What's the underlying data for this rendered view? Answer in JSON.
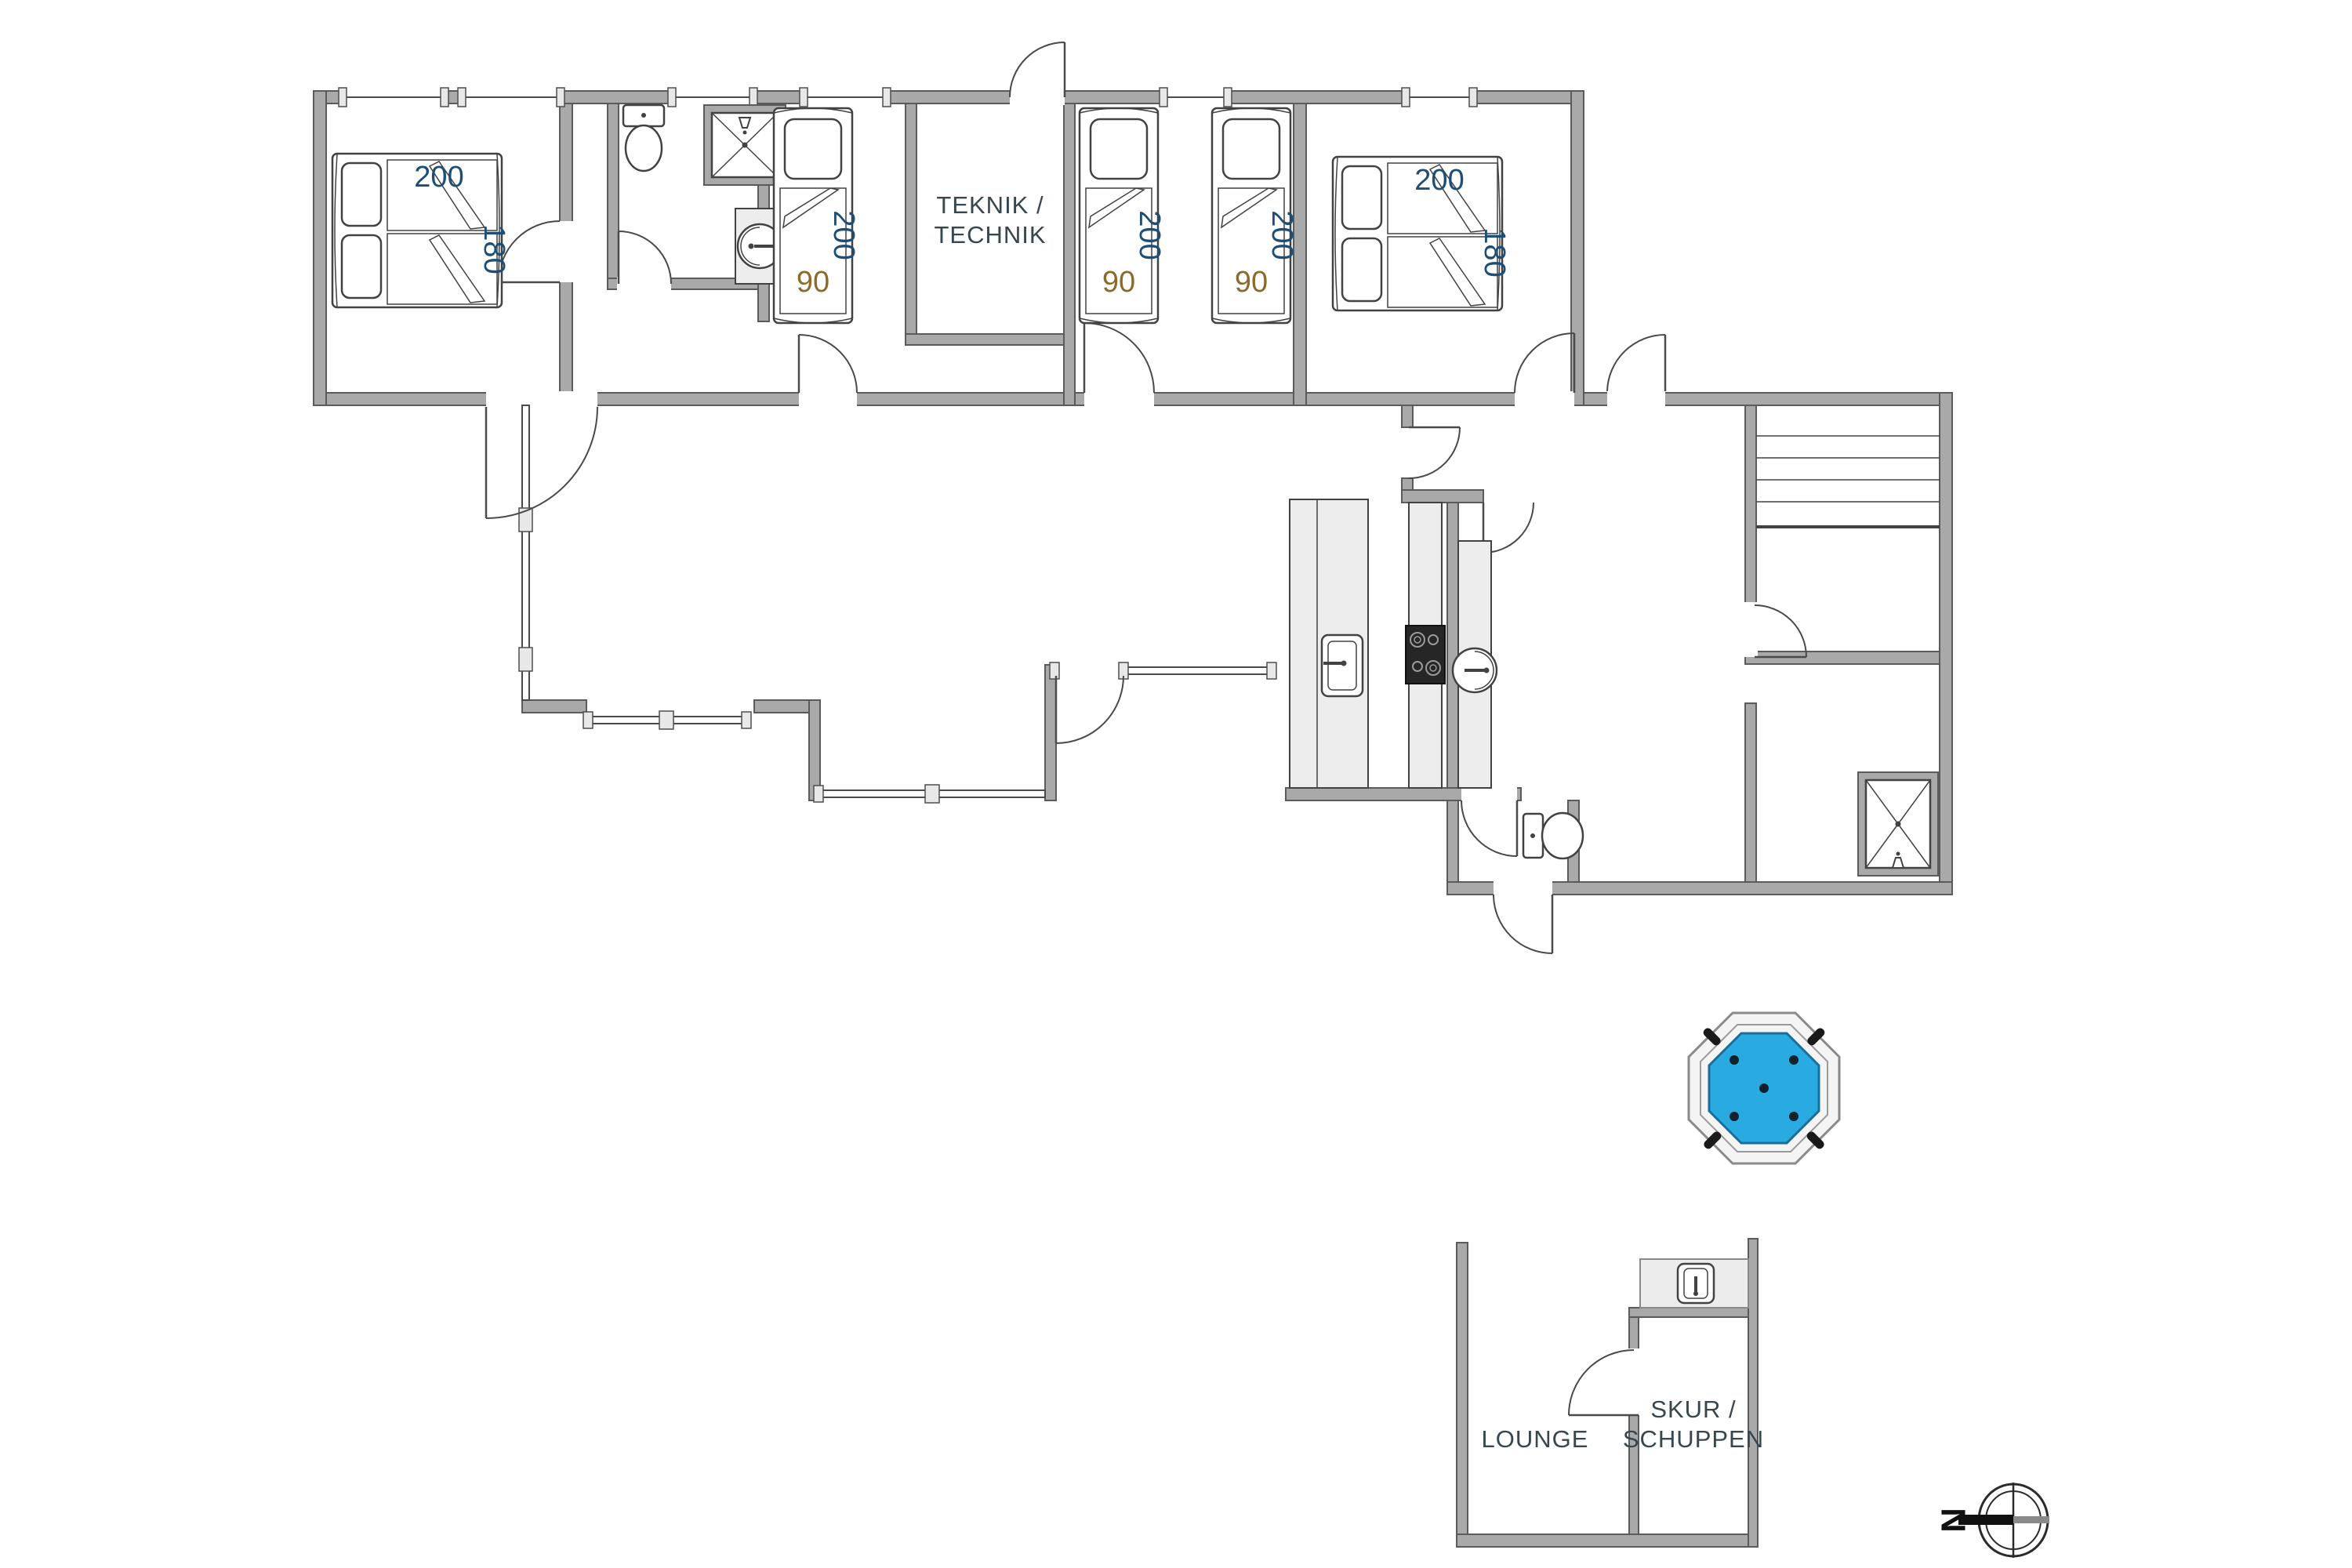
{
  "plan": {
    "type": "floor-plan",
    "colors": {
      "wall": "#a9a9a9",
      "wall_stroke": "#5b5b5b",
      "dimension_length": "#1d4e77",
      "dimension_width": "#8a6b29",
      "room_label": "#37474f",
      "hot_tub_water": "#29abe2",
      "cooktop": "#262626"
    },
    "rooms": {
      "technik_line1": "TEKNIK /",
      "technik_line2": "TECHNIK",
      "lounge": "LOUNGE",
      "shed_line1": "SKUR /",
      "shed_line2": "SCHUPPEN"
    },
    "beds": {
      "double_left": {
        "length": "200",
        "width": "180"
      },
      "single_1": {
        "length": "200",
        "width": "90"
      },
      "twin_left": {
        "length": "200",
        "width": "90"
      },
      "twin_right": {
        "length": "200",
        "width": "90"
      },
      "double_right": {
        "length": "200",
        "width": "180"
      }
    },
    "compass": {
      "north": "N"
    }
  }
}
